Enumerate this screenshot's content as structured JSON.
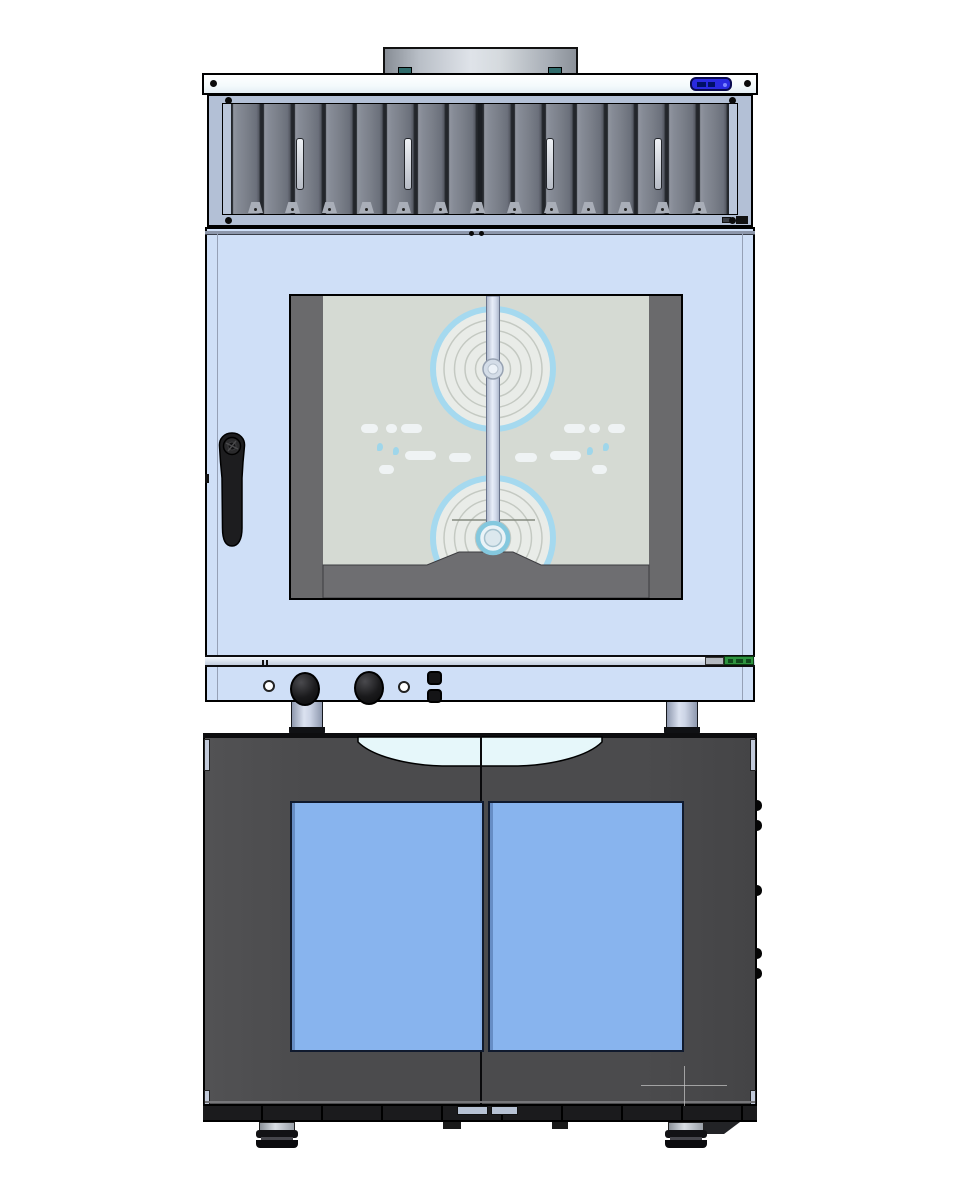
{
  "meta": {
    "width": 970,
    "height": 1200,
    "background": "#ffffff",
    "description": "Front-view CAD render of a combi steam oven with condensation hood and exhaust vent, stacked on a dark two-door glass proofer cabinet"
  },
  "palette": {
    "door_blue": "#cfdff7",
    "hood_frame": "#b3c0d6",
    "hood_inner_edge": "#bac6da",
    "display_blue": "#2a2ae0",
    "display_border": "#0a0a50",
    "window_interior": "#d5dad3",
    "window_band": "#6a6a6c",
    "fan_fill": "#e9ece8",
    "fan_line": "#c4c9c2",
    "fan_ring": "#a5d9ef",
    "hub_cyan": "#84c8de",
    "rating_green": "#2e9440",
    "glass_blue": "#88b4ee",
    "cabinet_dark": "#4b4b4d",
    "recess_white": "#e6f7fa",
    "handle_black": "#1d1d1f"
  },
  "hood": {
    "slat_count": 16,
    "handle_centers": [
      300,
      408,
      550,
      658
    ],
    "handle_top": 138,
    "tabs": {
      "start_x": 248,
      "step": 37,
      "count": 13,
      "top": 202
    },
    "screws": [
      [
        228,
        100
      ],
      [
        732,
        100
      ],
      [
        228,
        220
      ],
      [
        732,
        220
      ],
      [
        213,
        83
      ],
      [
        747,
        83
      ]
    ]
  },
  "oven": {
    "steam_pills": [
      [
        70,
        128,
        17
      ],
      [
        95,
        128,
        11
      ],
      [
        110,
        128,
        21
      ],
      [
        273,
        128,
        21
      ],
      [
        298,
        128,
        11
      ],
      [
        317,
        128,
        17
      ],
      [
        114,
        155,
        31
      ],
      [
        158,
        157,
        22
      ],
      [
        224,
        157,
        22
      ],
      [
        259,
        155,
        31
      ],
      [
        88,
        169,
        15
      ],
      [
        301,
        169,
        15
      ]
    ],
    "droplets": [
      [
        86,
        147
      ],
      [
        312,
        147
      ],
      [
        102,
        151
      ],
      [
        296,
        151
      ]
    ],
    "controls": {
      "knobs": [
        [
          305,
          689
        ],
        [
          369,
          688
        ]
      ],
      "indicators": [
        [
          269,
          686
        ],
        [
          404,
          687
        ]
      ],
      "buttons": [
        [
          434,
          678
        ],
        [
          434,
          696
        ]
      ]
    }
  },
  "legs": {
    "tops": [
      [
        291,
        702
      ],
      [
        666,
        702
      ]
    ]
  },
  "cabinet": {
    "glass_panes": [
      [
        290,
        801,
        194,
        251
      ],
      [
        488,
        801,
        196,
        251
      ]
    ],
    "hinge_ys": [
      800,
      820,
      885,
      948,
      968
    ],
    "stop_tabs": [
      [
        457,
        1106,
        31
      ],
      [
        491,
        1106,
        27
      ]
    ],
    "base_clips": [
      [
        443,
        1122,
        18,
        7
      ],
      [
        552,
        1122,
        16,
        7
      ]
    ],
    "feet": [
      [
        259,
        1122
      ],
      [
        668,
        1122
      ]
    ]
  }
}
